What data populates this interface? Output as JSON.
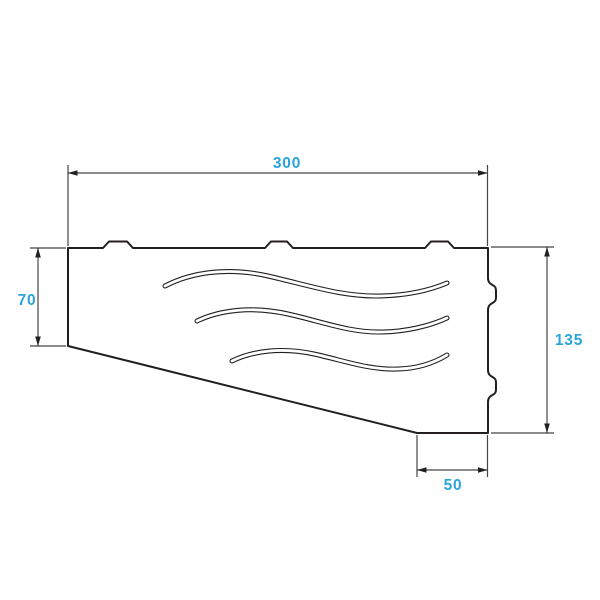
{
  "drawing": {
    "kind": "technical-dimension-drawing",
    "dimensions": {
      "top_width": {
        "label": "300"
      },
      "left_height": {
        "label": "70"
      },
      "right_height": {
        "label": "135"
      },
      "bottom_width": {
        "label": "50"
      }
    },
    "features": {
      "top_tabs_count": 3,
      "right_notches_count": 2,
      "wave_slots_count": 3
    },
    "colors": {
      "dimension_text": "#2ba4da",
      "outline": "#231f20",
      "dimension_lines": "#454545",
      "background": "#ffffff"
    }
  }
}
